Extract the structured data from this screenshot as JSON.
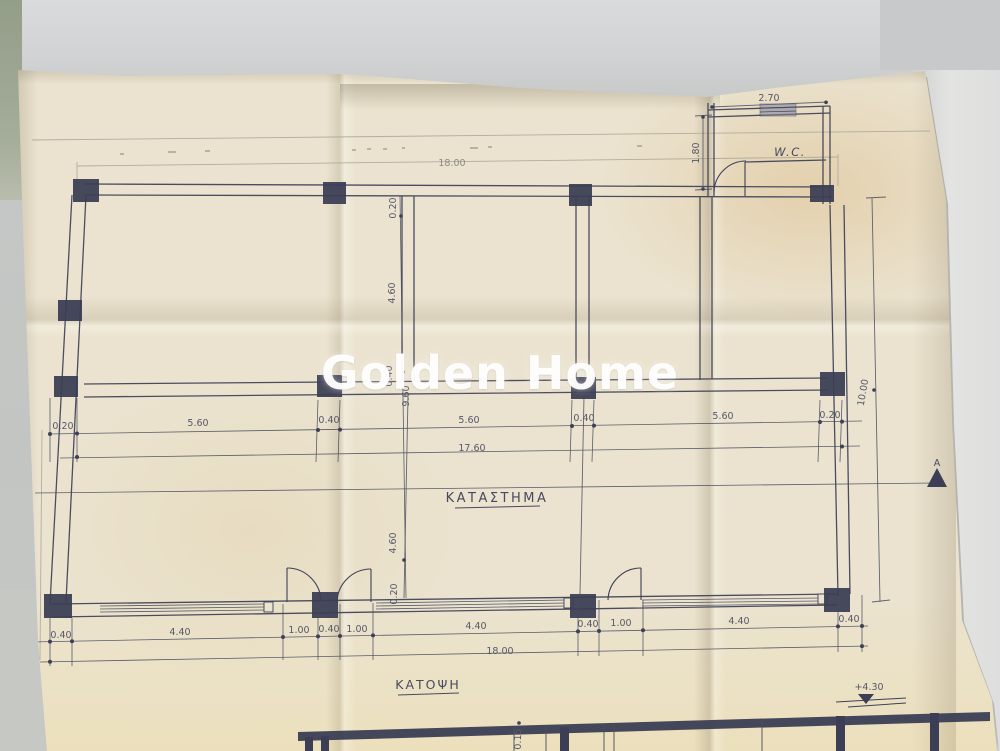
{
  "meta": {
    "watermark": "Golden Home"
  },
  "plan": {
    "room_label": "ΚΑΤΑΣΤΗΜΑ",
    "wc_label": "W.C.",
    "title": "ΚΑΤΟΨΗ",
    "section_marker": "A",
    "level_annotation": "+4.30"
  },
  "dimensions": {
    "top_total": "18.00",
    "wc_width": "2.70",
    "wc_depth": "1.80",
    "mid_row": [
      "0.20",
      "5.60",
      "0.40",
      "5.60",
      "0.40",
      "5.60",
      "0.20"
    ],
    "mid_total": "17.60",
    "vertical_chain": [
      "0.20",
      "4.60",
      "0.40",
      "9.60",
      "4.60",
      "0.20"
    ],
    "right_depth_total": "10.00",
    "bottom_row": [
      "0.40",
      "4.40",
      "1.00",
      "0.40",
      "1.00",
      "4.40",
      "0.40",
      "1.00",
      "4.40",
      "0.40"
    ],
    "bottom_total": "18.00",
    "section_dim": "0.15"
  },
  "colors": {
    "ink": "#3d4056",
    "paper": "#ebe3cf",
    "pencil": "#a39f94"
  }
}
